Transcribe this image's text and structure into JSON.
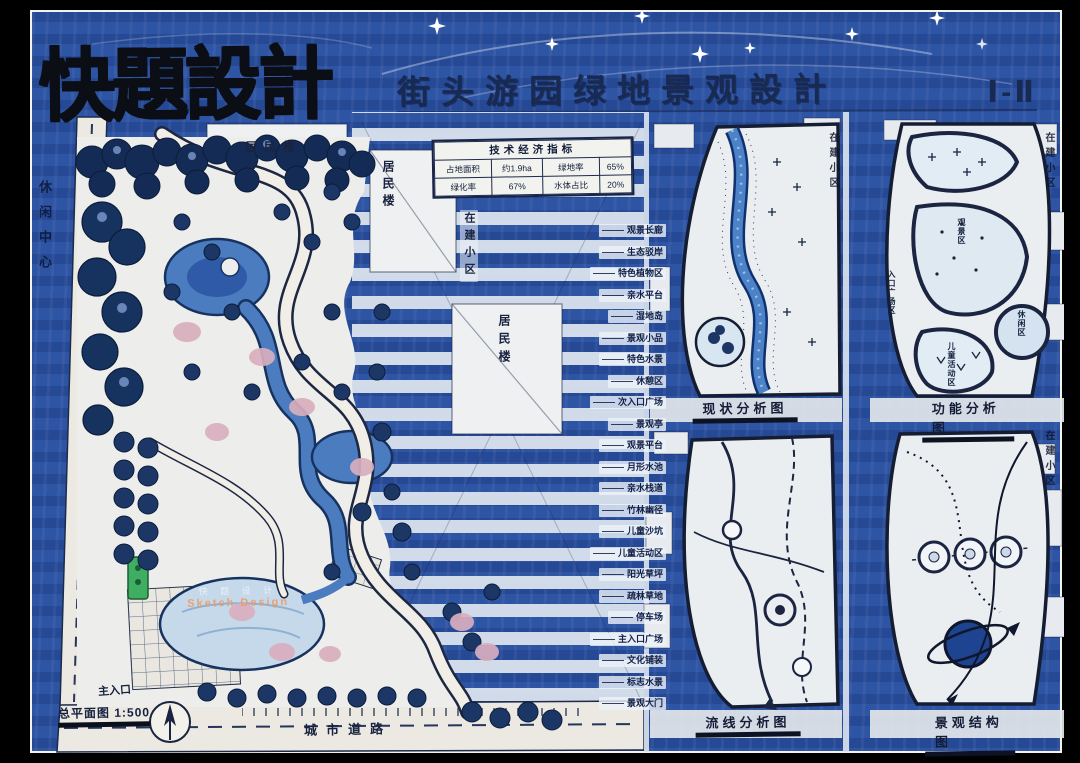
{
  "title": {
    "main": "快題設計",
    "sub": "街头游园绿地景观設計",
    "sheet_no": "Ⅰ-Ⅱ"
  },
  "indicators": {
    "title": "技术经济指标",
    "cells": {
      "r1c1": "占地面积",
      "r1c2": "约1.9ha",
      "r1c3": "绿地率",
      "r1c4": "65%",
      "r2c1": "绿化率",
      "r2c2": "67%",
      "r2c3": "水体占比",
      "r2c4": "20%"
    }
  },
  "surroundings": {
    "residential": "居民楼",
    "under_construction": "在建小区",
    "leisure_center": "休闲中心",
    "city_road": "城市道路"
  },
  "plan": {
    "drawing_label": "总平面图 1:500",
    "main_entrance": "主入口",
    "annotations": [
      "观景长廊",
      "生态驳岸",
      "特色植物区",
      "亲水平台",
      "湿地岛",
      "景观小品",
      "特色水景",
      "休憩区",
      "次入口广场",
      "景观亭",
      "观景平台",
      "月形水池",
      "亲水栈道",
      "竹林幽径",
      "儿童沙坑",
      "儿童活动区",
      "阳光草坪",
      "疏林草地",
      "停车场",
      "主入口广场",
      "文化铺装",
      "标志水景",
      "景观大门"
    ]
  },
  "diagrams": [
    {
      "title": "现状分析图"
    },
    {
      "title": "功能分析图",
      "zones": [
        "观景区",
        "休闲区",
        "儿童活动区",
        "入口广场区"
      ]
    },
    {
      "title": "流线分析图"
    },
    {
      "title": "景观结构图"
    }
  ],
  "watermark": {
    "cn": "快 题 设 计",
    "en": "Sketch Design"
  },
  "colors": {
    "marker_blue": "#2b50a0",
    "paper": "#edeeec",
    "ink": "#131b2e",
    "water": "#4c7cc0",
    "tree_navy": "#1b3364",
    "accent_pink": "#d9aebe",
    "accent_green": "#3fae62"
  }
}
